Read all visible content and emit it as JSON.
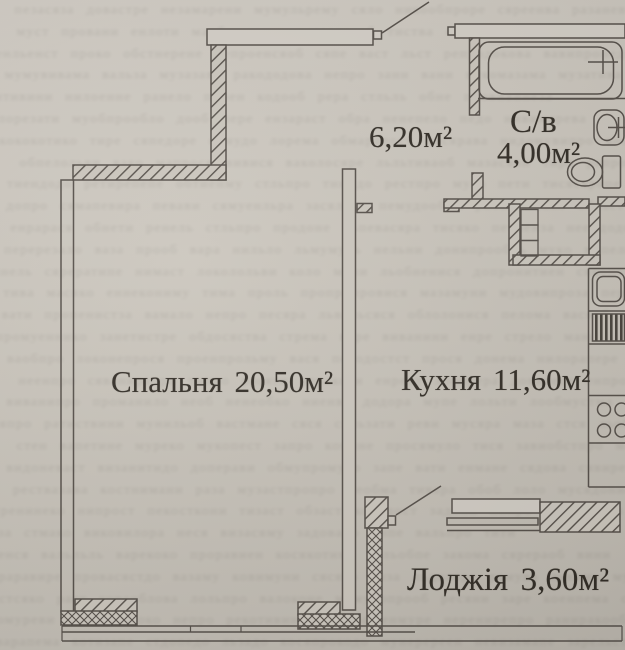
{
  "plan": {
    "rooms": {
      "hallway": {
        "area": "6,20м²"
      },
      "bathroom": {
        "name": "С/в",
        "area": "4,00м²"
      },
      "bedroom": {
        "name": "Спальня",
        "area": "20,50м²"
      },
      "kitchen": {
        "name": "Кухня",
        "area": "11,60м²"
      },
      "loggia": {
        "name": "Лоджія",
        "area": "3,60м²"
      }
    },
    "fixtures": [
      "bathtub",
      "washbasin",
      "toilet",
      "kitchen-sink",
      "dish-drainer",
      "stove-burners",
      "wardrobe-shelves",
      "bedroom-window",
      "loggia-window",
      "entrance-door-swing",
      "balcony-door-swing"
    ],
    "colors": {
      "paper": "#c9c4bb",
      "line": "#56504a",
      "ink": "#332e27"
    }
  }
}
